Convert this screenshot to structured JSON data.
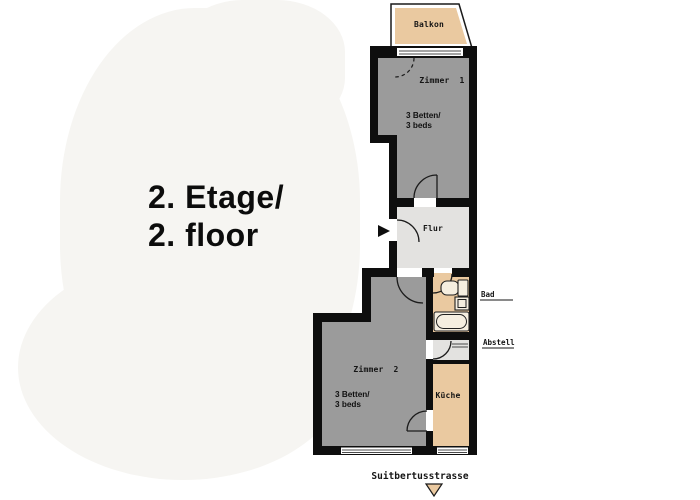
{
  "title": {
    "line1": "2. Etage/",
    "line2": "2. floor"
  },
  "plan": {
    "balkon": {
      "label": "Balkon"
    },
    "zimmer1": {
      "label": "Zimmer  1",
      "beds_line1": "3 Betten/",
      "beds_line2": "3 beds"
    },
    "flur": {
      "label": "Flur"
    },
    "bad": {
      "label": "Bad"
    },
    "abstell": {
      "label": "Abstell"
    },
    "zimmer2": {
      "label": "Zimmer  2",
      "beds_line1": "3 Betten/",
      "beds_line2": "3 beds"
    },
    "kueche": {
      "label": "Küche"
    },
    "street": {
      "label": "Suitbertusstrasse"
    }
  },
  "colors": {
    "wall": "#0e0e0e",
    "room_gray": "#9b9b9b",
    "room_light_gray": "#e3e2e0",
    "room_tan": "#eac9a0",
    "fixture_fill": "#f5eee0",
    "text": "#151515",
    "background": "#ffffff"
  }
}
